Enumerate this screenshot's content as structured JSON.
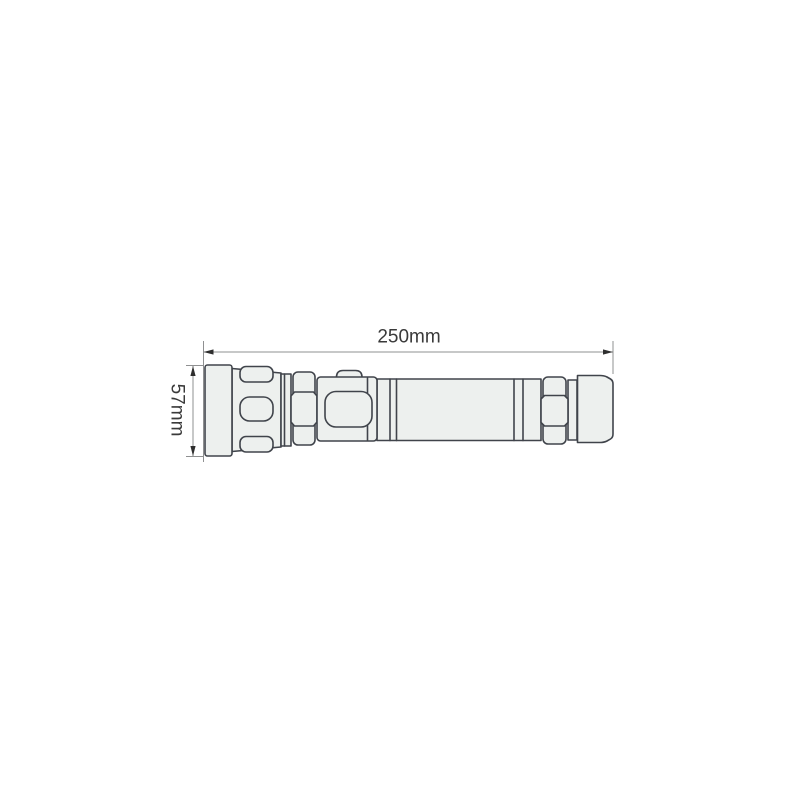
{
  "diagram": {
    "type": "technical-drawing",
    "subject": "flashlight-side-view",
    "dimensions": {
      "length_label": "250mm",
      "height_label": "57mm"
    },
    "colors": {
      "background": "#ffffff",
      "body_fill": "#edf0ee",
      "outline": "#40444b",
      "dimension_line": "#8f9091",
      "arrow": "#2e2e2e",
      "label_text": "#3a3a3a"
    },
    "parts": [
      "front-bezel",
      "tapered-head-grip",
      "front-knurled-ring",
      "switch-button",
      "switch-panel",
      "battery-tube",
      "rear-knurled-ring",
      "tail-cap"
    ]
  }
}
